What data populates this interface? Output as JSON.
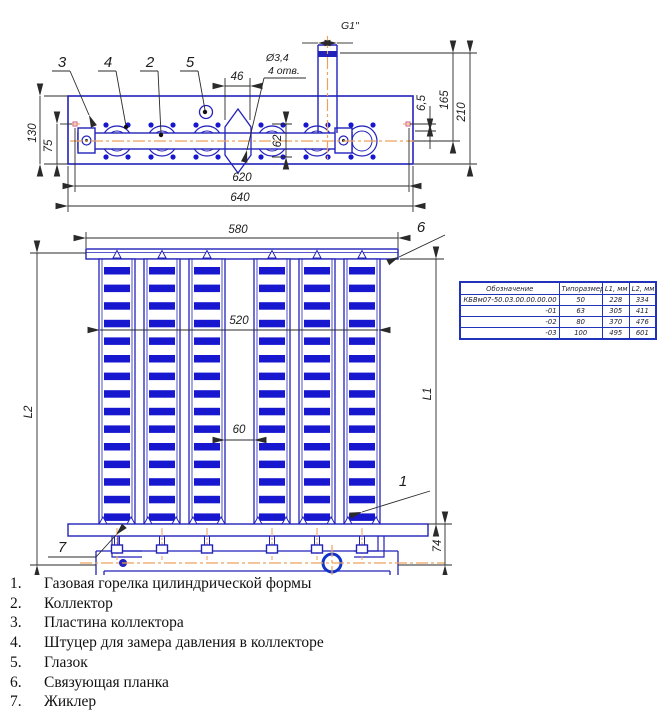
{
  "colors": {
    "line_blue": "#2222bb",
    "slot_blue": "#1717cf",
    "centerline_orange": "#eda15e",
    "dimension_ink": "#2a2a2a"
  },
  "top_view": {
    "callout_3": "3",
    "callout_4": "4",
    "callout_2": "2",
    "callout_5": "5",
    "dim_46": "46",
    "hole_dia": "Ø3,4",
    "hole_count": "4 отв.",
    "dim_g1": "G1\"",
    "dim_62": "62",
    "dim_130": "130",
    "dim_75": "75",
    "dim_620": "620",
    "dim_640": "640",
    "dim_6_5": "6,5",
    "dim_165": "165",
    "dim_210": "210"
  },
  "front_view": {
    "callout_6": "6",
    "callout_1": "1",
    "callout_7": "7",
    "dim_580": "580",
    "dim_520": "520",
    "dim_60": "60",
    "dim_L1": "L1",
    "dim_L2": "L2",
    "dim_74": "74"
  },
  "table": {
    "headers": [
      "Обозначение",
      "Типоразмер",
      "L1, мм",
      "L2, мм"
    ],
    "rows": [
      [
        "КБВм07-50.03.00.00.00.00",
        "50",
        "228",
        "334"
      ],
      [
        "-01",
        "63",
        "305",
        "411"
      ],
      [
        "-02",
        "80",
        "370",
        "476"
      ],
      [
        "-03",
        "100",
        "495",
        "601"
      ]
    ]
  },
  "parts_list": [
    {
      "num": "1.",
      "label": "Газовая горелка цилиндрической формы"
    },
    {
      "num": "2.",
      "label": "Коллектор"
    },
    {
      "num": "3.",
      "label": "Пластина коллектора"
    },
    {
      "num": "4.",
      "label": "Штуцер для замера давления в коллекторе"
    },
    {
      "num": "5.",
      "label": "Глазок"
    },
    {
      "num": "6.",
      "label": "Связующая планка"
    },
    {
      "num": "7.",
      "label": "Жиклер"
    }
  ],
  "geometry": {
    "tube_centers": [
      117,
      162,
      207,
      272,
      317,
      362
    ],
    "slots_per_tube": 15,
    "top_circle_r_outer": 15,
    "top_circle_r_inner": 10
  }
}
